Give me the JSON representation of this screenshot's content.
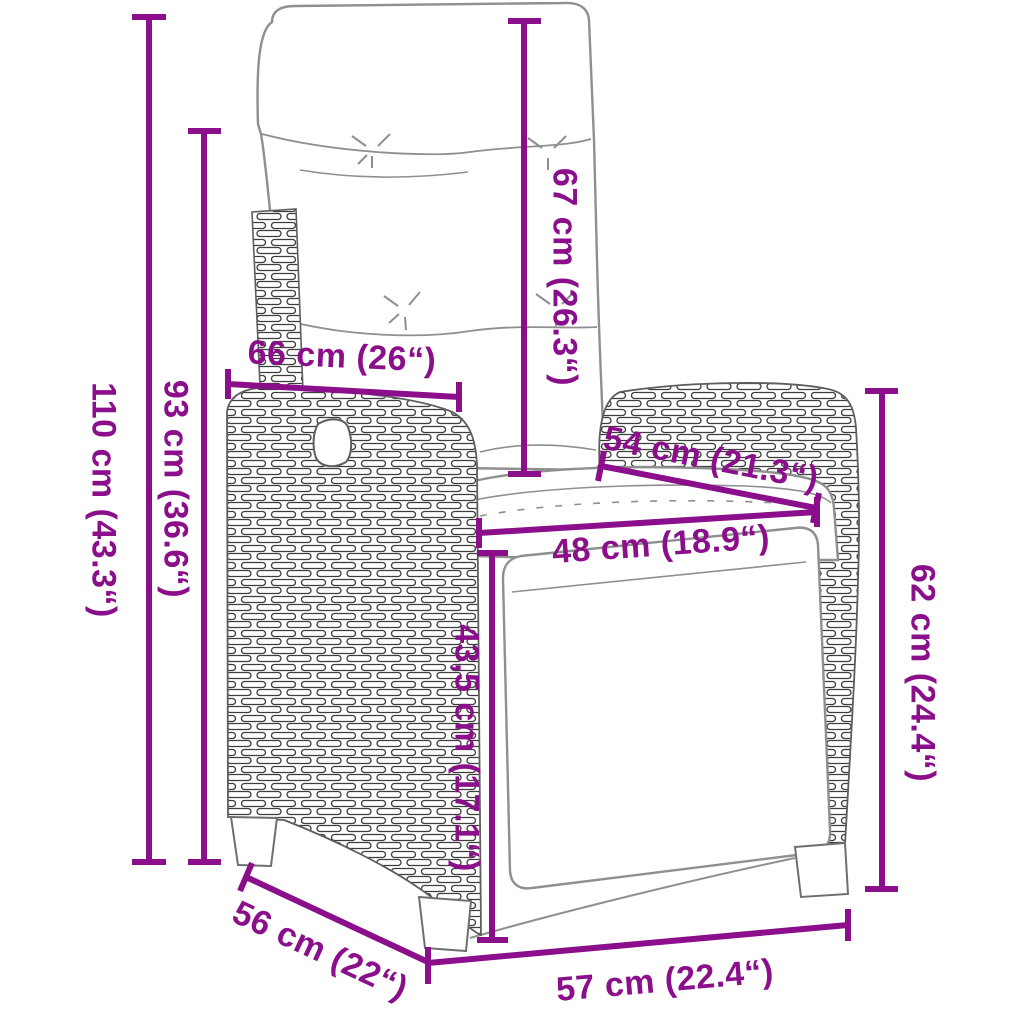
{
  "illustration": "wicker-reclining-garden-chair-with-cushion-and-footrest-line-drawing",
  "colors": {
    "accent": "#8B0F8B",
    "line_art": "#8f8f8f",
    "wicker_stroke": "#3d3d3d",
    "background": "#ffffff"
  },
  "dimensions": [
    {
      "name": "total-height",
      "text": "110 cm (43.3“)"
    },
    {
      "name": "backrest-height",
      "text": "93 cm (36.6“)"
    },
    {
      "name": "backrest-width",
      "text": "66 cm (26“)"
    },
    {
      "name": "cushion-back-height",
      "text": "67 cm (26.3“)"
    },
    {
      "name": "armrest-depth",
      "text": "54 cm (21.3“)"
    },
    {
      "name": "seat-width",
      "text": "48 cm (18.9“)"
    },
    {
      "name": "seat-height",
      "text": "43,5 cm (17.1“)"
    },
    {
      "name": "armrest-height",
      "text": "62 cm (24.4“)"
    },
    {
      "name": "seat-depth",
      "text": "56 cm (22“)"
    },
    {
      "name": "base-width",
      "text": "57 cm (22.4“)"
    }
  ]
}
